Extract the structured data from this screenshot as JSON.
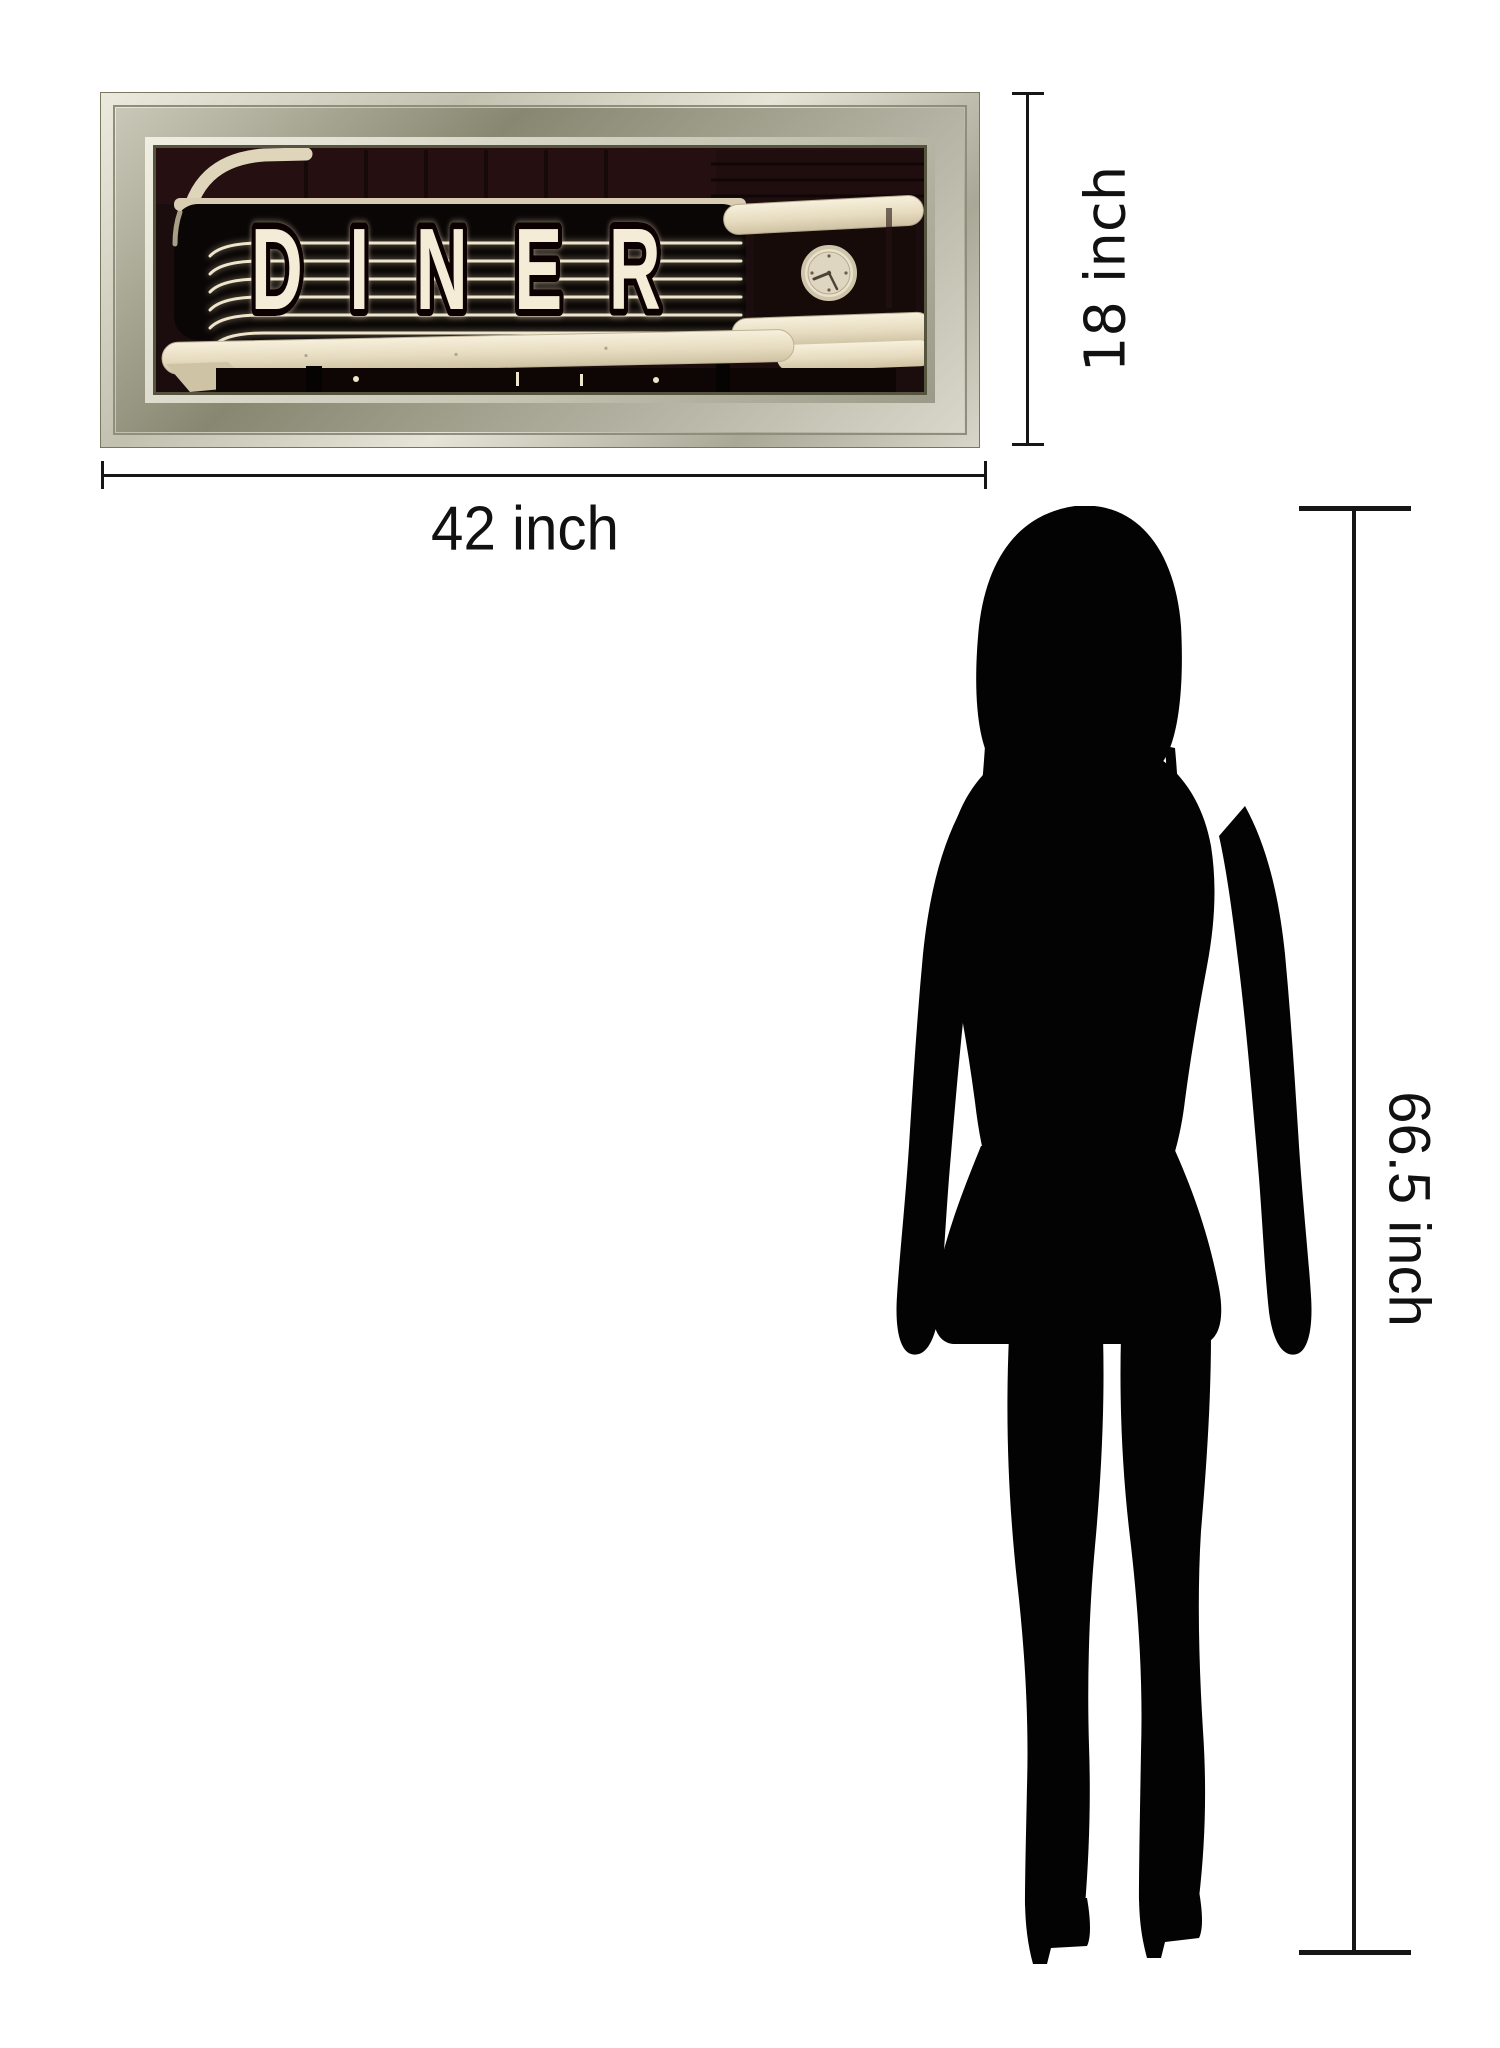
{
  "page": {
    "background_color": "#ffffff"
  },
  "artwork": {
    "sign_text": "DINER",
    "frame_silver": "#b9b7a6",
    "frame_highlight": "#ebe9dc",
    "frame_shadow": "#74735f",
    "photo_background": "#1b0d0d",
    "neon_cream": "#f2e9d3",
    "tube_cream": "#e9dfc6"
  },
  "dimensions": {
    "width": {
      "label": "42 inch"
    },
    "height": {
      "label": "18 inch"
    },
    "person_height": {
      "label": "66.5 inch"
    },
    "line_color": "#161616",
    "label_color": "#111111"
  },
  "silhouette": {
    "color": "#030303"
  }
}
